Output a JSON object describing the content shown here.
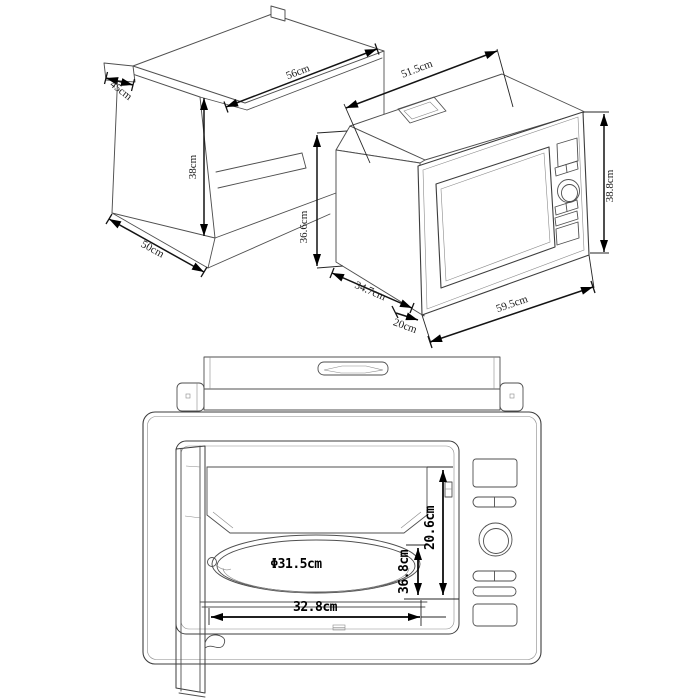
{
  "colors": {
    "background": "#ffffff",
    "line": "#4f4f4f",
    "dimension": "#111111"
  },
  "cabinet": {
    "top_edge": "45cm",
    "front_width": "56cm",
    "height": "38cm",
    "bottom_edge": "50cm"
  },
  "microwave": {
    "top_width": "51.5cm",
    "body_height": "36.6cm",
    "side_depth": "34.7cm",
    "front_overhang": "20cm",
    "frame_width": "59.5cm",
    "frame_height": "38.8cm"
  },
  "front_view": {
    "turntable_diameter": "Φ31.5cm",
    "interior_width": "32.8cm",
    "interior_depth": "36.8cm",
    "interior_height": "20.6cm"
  }
}
